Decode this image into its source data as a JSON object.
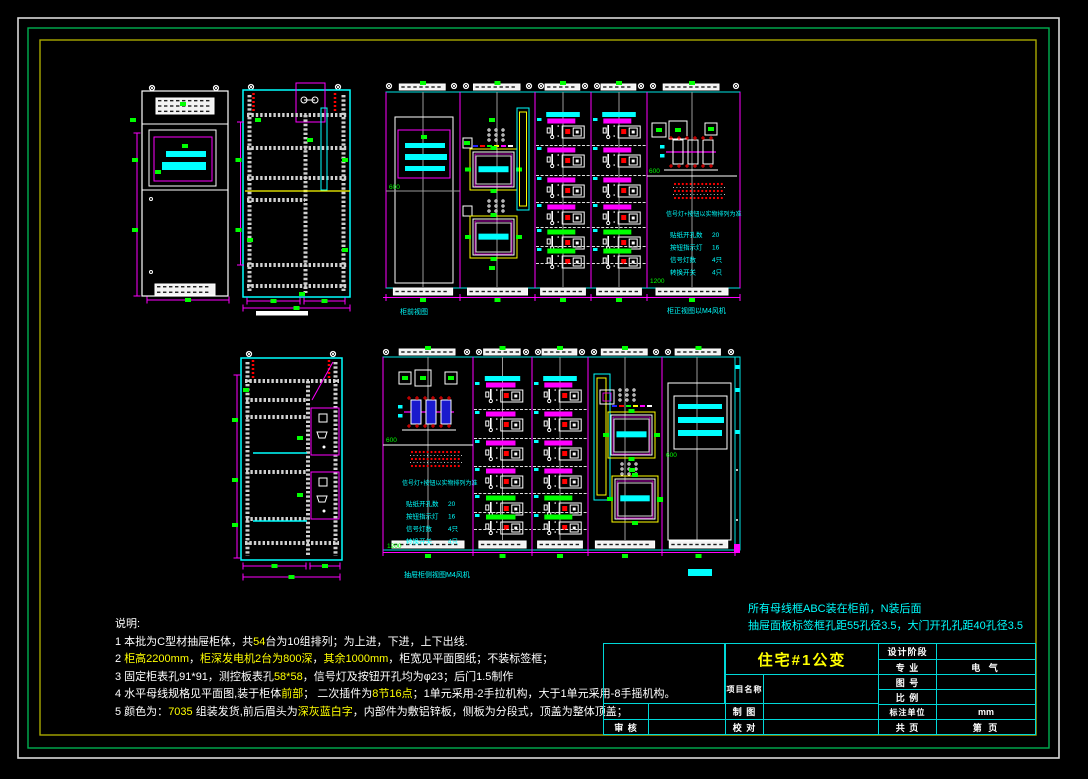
{
  "sheet": {
    "bg": "#000000",
    "border_colors": {
      "outer": "#d9d9d9",
      "middle": "#00b050",
      "inner": "#a8a800"
    },
    "line_colors": {
      "cyan": "#00ffff",
      "magenta": "#ff00ff",
      "green": "#00ff00",
      "yellow": "#ffff00",
      "white": "#ffffff",
      "red": "#ff0000",
      "gray": "#9a9a9a"
    }
  },
  "notes_top": {
    "line1": "所有母线框ABC装在柜前，N装后面",
    "line2": "抽屉面板标签框孔距55孔径3.5，大门开孔孔距40孔径3.5"
  },
  "shuoming": {
    "title": "说明:",
    "lines": [
      [
        {
          "t": "1 本批为C型材抽屉柜体，共",
          "c": "w"
        },
        {
          "t": "54",
          "c": "y"
        },
        {
          "t": "台为10组排列；为上进，下进，上下出线.",
          "c": "w"
        }
      ],
      [
        {
          "t": "2 ",
          "c": "w"
        },
        {
          "t": "柜高2200mm",
          "c": "y"
        },
        {
          "t": "，",
          "c": "w"
        },
        {
          "t": "柜深发电机2台为800深",
          "c": "y"
        },
        {
          "t": "，",
          "c": "w"
        },
        {
          "t": "其余1000mm",
          "c": "y"
        },
        {
          "t": "，柜宽见平面图纸；不装标签框；",
          "c": "w"
        }
      ],
      [
        {
          "t": "3 固定柜表孔91*91，测控板表孔",
          "c": "w"
        },
        {
          "t": "58*58",
          "c": "y"
        },
        {
          "t": "，信号灯及按钮开孔均为φ23；后门1.5制作",
          "c": "w"
        }
      ],
      [
        {
          "t": "4 水平母线规格见平面图,装于柜体",
          "c": "w"
        },
        {
          "t": "前部",
          "c": "y"
        },
        {
          "t": "；  二次插件为",
          "c": "w"
        },
        {
          "t": "8节16点",
          "c": "y"
        },
        {
          "t": "；1单元采用-2手拉机构，大于1单元采用-8手摇机构。",
          "c": "w"
        }
      ],
      [
        {
          "t": "5 颜色为：",
          "c": "w"
        },
        {
          "t": "7035",
          "c": "y"
        },
        {
          "t": " 组装发货,前后眉头为",
          "c": "w"
        },
        {
          "t": "深灰蓝白字",
          "c": "y"
        },
        {
          "t": "，内部件为敷铝锌板，侧板为分段式，顶盖为整体顶盖；",
          "c": "w"
        }
      ]
    ]
  },
  "captions": {
    "group_b_left": "柜前视图",
    "group_b_right": "柜正视图以M4风机",
    "group_d_bottom": "抽屉柜侧视图M4风机"
  },
  "dim_labels": {
    "h600": "600",
    "h1200": "1200"
  },
  "panel_text_block": {
    "header": "信号灯+按钮以实物排列为准",
    "rows": [
      {
        "label": "贴纸开孔数",
        "value": "20"
      },
      {
        "label": "按钮指示灯",
        "value": "16"
      },
      {
        "label": "信号灯数",
        "value": "4只"
      },
      {
        "label": "转换开关",
        "value": "4只"
      }
    ]
  },
  "title_block": {
    "title": "住宅#1公变",
    "project_name_label": "项目名称",
    "draw_label": "制 图",
    "check_label": "校 对",
    "audit_label": "审 核",
    "rows": [
      {
        "label": "设计阶段",
        "value": ""
      },
      {
        "label": "专 业",
        "value": "电 气"
      },
      {
        "label": "图 号",
        "value": ""
      },
      {
        "label": "比 例",
        "value": ""
      },
      {
        "label": "标注单位",
        "value": "mm"
      },
      {
        "label": "共  页",
        "value": "第  页"
      }
    ]
  }
}
